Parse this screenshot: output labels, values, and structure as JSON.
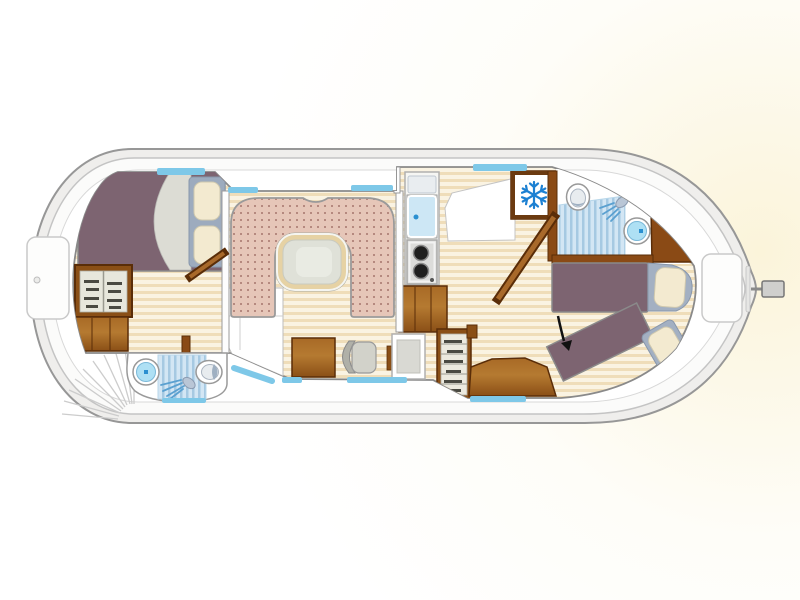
{
  "diagram": {
    "type": "houseboat-floor-plan",
    "elements": [
      "hull",
      "bow-locker",
      "stern-locker",
      "rudder",
      "bow-steps-fan",
      "front-cabin-double-bed",
      "front-cabin-pillows",
      "front-wardrobe",
      "front-cabinet",
      "front-bathroom",
      "front-shower",
      "front-shower-tray",
      "front-toilet",
      "salon-u-sofa",
      "salon-table",
      "desk",
      "desk-chair",
      "side-table",
      "galley-counter",
      "galley-sink",
      "galley-stove",
      "galley-cabinet",
      "refrigerator",
      "aft-bathroom",
      "aft-toilet",
      "aft-washbasin",
      "aft-shower",
      "aft-cabin-bed",
      "aft-cabin-angled-bed",
      "aft-wardrobe",
      "aft-platform",
      "front-cabin-door",
      "aft-cabin-door",
      "bathroom-door-post",
      "windows",
      "arrow-annotation"
    ],
    "icons": {
      "refrigerator": "snowflake-icon",
      "front-bathroom": "shower-head-icon",
      "aft-bathroom": "shower-head-icon",
      "annotation": "arrow-down-right-icon"
    }
  },
  "colors": {
    "hull_outline": "#979797",
    "hull_band": "#efeeec",
    "walkway": "#fbfbfa",
    "wall_stroke": "#8a8a8a",
    "window_blue": "#7ec8e8",
    "floor_light": "#faf3e2",
    "floor_dark": "#efddb9",
    "wood_dark": "#5a2d08",
    "wood_mid": "#955618",
    "wood_light": "#b57a31",
    "bed_purple": "#7d6471",
    "blanket_grey": "#dcdcd4",
    "pillow_cream": "#f3ead0",
    "pillow_frame": "#a3b0c2",
    "sofa_pink": "#e6c6b8",
    "sofa_dot": "#b5897f",
    "table_ring": "#e6d2a4",
    "table_top": "#dfe1d8",
    "shower_light": "#d3e6f4",
    "shower_stripe": "#a6c9e2",
    "fixture_blue": "#aee0f4",
    "accent_blue": "#2a8fd0",
    "snowflake_blue": "#1c80d2",
    "stove_grey": "#dcdcda",
    "burner_black": "#1f1f1f",
    "arrow_black": "#111111"
  }
}
